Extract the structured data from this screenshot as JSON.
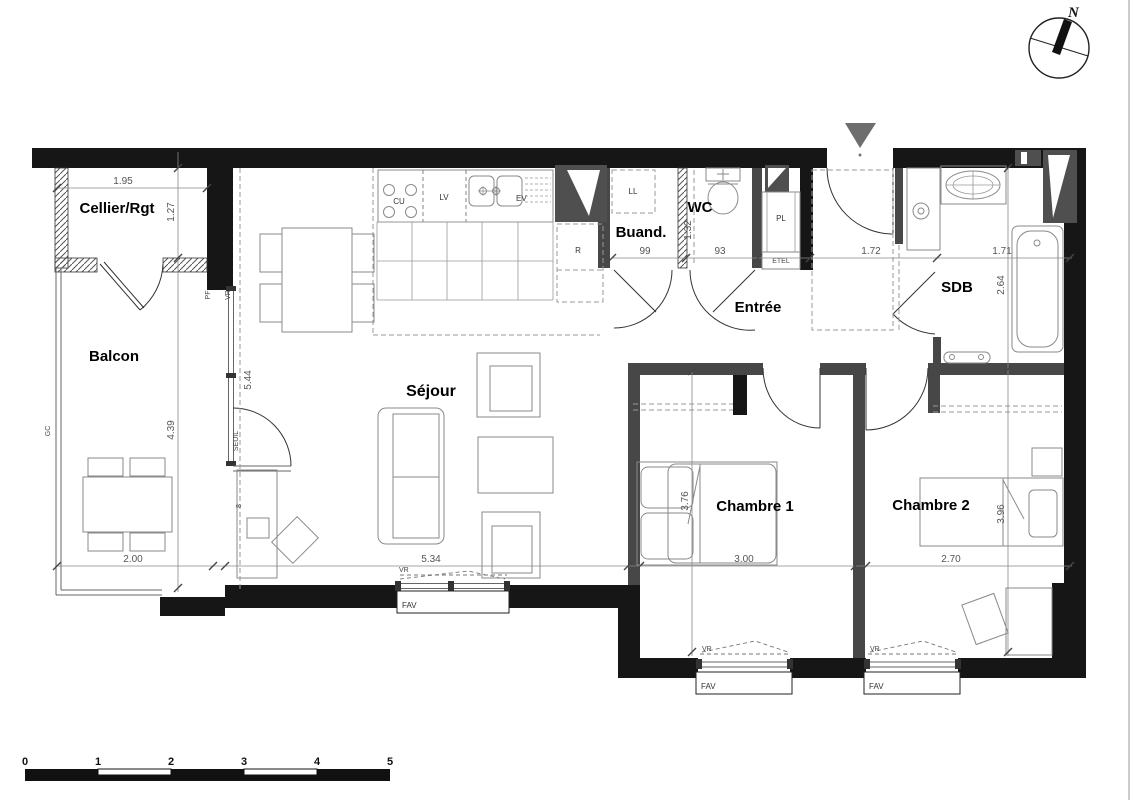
{
  "compass": {
    "label": "N"
  },
  "entrance_marker_color": "#6e6e6e",
  "rooms": {
    "cellier": {
      "label": "Cellier/Rgt",
      "dim_width": "1.95",
      "dim_height": "1.27"
    },
    "balcon": {
      "label": "Balcon",
      "dim_width": "2.00",
      "dim_height": "4.39"
    },
    "sejour": {
      "label": "Séjour",
      "dim_width": "5.34",
      "dim_height": "5.44"
    },
    "buanderie": {
      "label": "Buand.",
      "dim_width": "99",
      "washer": "LL"
    },
    "wc": {
      "label": "WC",
      "dim_width": "93",
      "dim_height": "1.32"
    },
    "entree": {
      "label": "Entrée",
      "dim_width": "1.72",
      "closet": "PL",
      "tech_box": "ETEL"
    },
    "sdb": {
      "label": "SDB",
      "dim_width": "1.71",
      "dim_height": "2.64"
    },
    "chambre1": {
      "label": "Chambre 1",
      "dim_width": "3.00",
      "dim_height": "3.76"
    },
    "chambre2": {
      "label": "Chambre 2",
      "dim_width": "2.70",
      "dim_height": "3.96"
    }
  },
  "kitchen": {
    "cooktop": "CU",
    "dishwasher": "LV",
    "sink": "EV",
    "fridge": "R"
  },
  "openings": {
    "window": "FAV",
    "shutter": "VR",
    "door_window": "PF",
    "railing": "GC",
    "threshold": "SEUIL",
    "desk_mark": "8"
  },
  "scale_bar": {
    "ticks": [
      "0",
      "1",
      "2",
      "3",
      "4",
      "5"
    ]
  }
}
